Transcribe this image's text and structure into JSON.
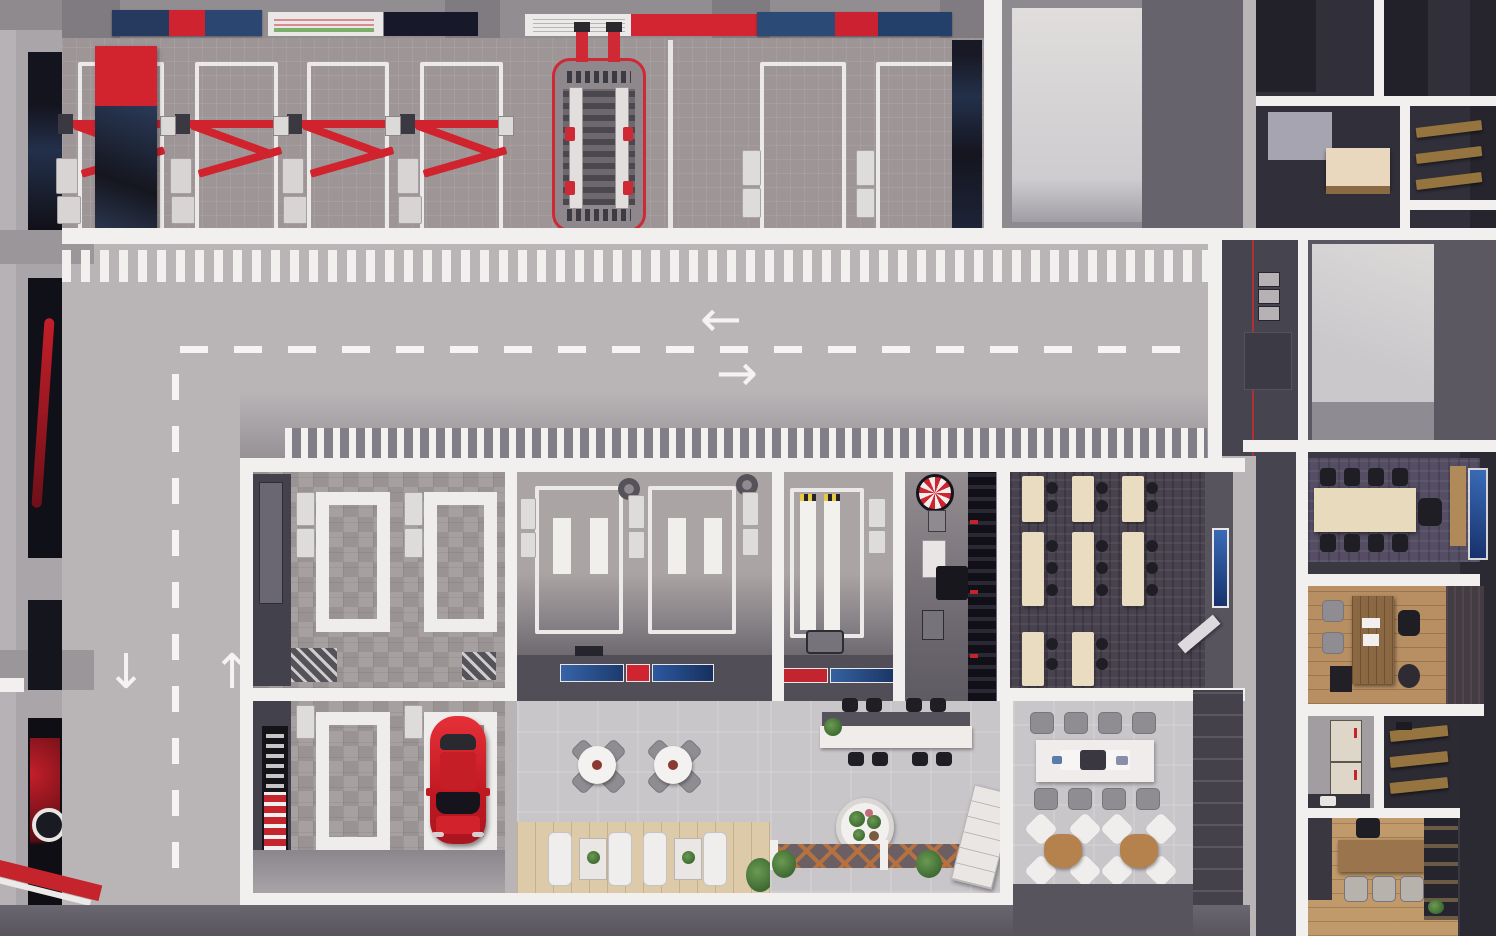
{
  "scene": {
    "name": "auto-service-center-floorplan-top-view",
    "type": "3d-architectural-render"
  },
  "palette": {
    "road": "#b9b4b6",
    "workshop_floor": "#9d9596",
    "wall_white": "#f2f0ee",
    "accent_red": "#d0232e",
    "car_red": "#d01f26",
    "dark_wall": "#4e4b54",
    "dark_room": "#31303a",
    "training_carpet": "#48424f",
    "meeting_carpet": "#544d63",
    "table_beige": "#e9dcc0",
    "marble_floor": "#c9c6ca",
    "deck_wood": "#dccaa9",
    "office_wood": "#b78f63",
    "screen_blue": "#2b57a0",
    "shelf_wood": "#96743f"
  },
  "markings": {
    "lane_arrow_left": "←",
    "lane_arrow_right": "→",
    "lane_arrow_down": "↓",
    "lane_arrow_up": "↑"
  },
  "areas": {
    "workshop": {
      "two_post_lift_bays": 4,
      "alignment_scissor_lift": 1,
      "spare_bays": 2,
      "wall_banners": 4,
      "side_poster": 1
    },
    "wash_zone": {
      "platforms": 4,
      "parked_car_color_red": 1,
      "wall_washers": 4,
      "tool_display_board": 1
    },
    "paint_prep": {
      "bays": 2,
      "floor_pads_per_bay": 2,
      "ceiling_fans": 2,
      "wall_posters": 5
    },
    "inspection_bay": {
      "runway_strips": 2
    },
    "tire_room": {
      "wheel_display": 1,
      "tire_rack": 1,
      "cabinet": 1,
      "desk": 1
    },
    "training_room": {
      "tables": 8,
      "wall_screen": 1,
      "whiteboard": 1
    },
    "lounge": {
      "round_tables": 2,
      "chairs_per_round_table": 4,
      "recliners": 4,
      "plant_tables": 2
    },
    "reception": {
      "counter": 1,
      "counter_chairs": 8,
      "round_planter": 1,
      "trellis": 1
    },
    "dining": {
      "long_table": 1,
      "long_table_chairs": 8,
      "lounge_sets": 2,
      "chairs_per_set": 4
    },
    "meeting_room": {
      "conference_table": 1,
      "chairs": 9,
      "wall_screen": 1
    },
    "manager_office": {
      "desk": 1,
      "guest_chairs": 2,
      "exec_chair": 1
    },
    "staff_room": {
      "table": 1,
      "chairs": 4
    },
    "storage": {
      "shelf_rooms": 4
    }
  }
}
